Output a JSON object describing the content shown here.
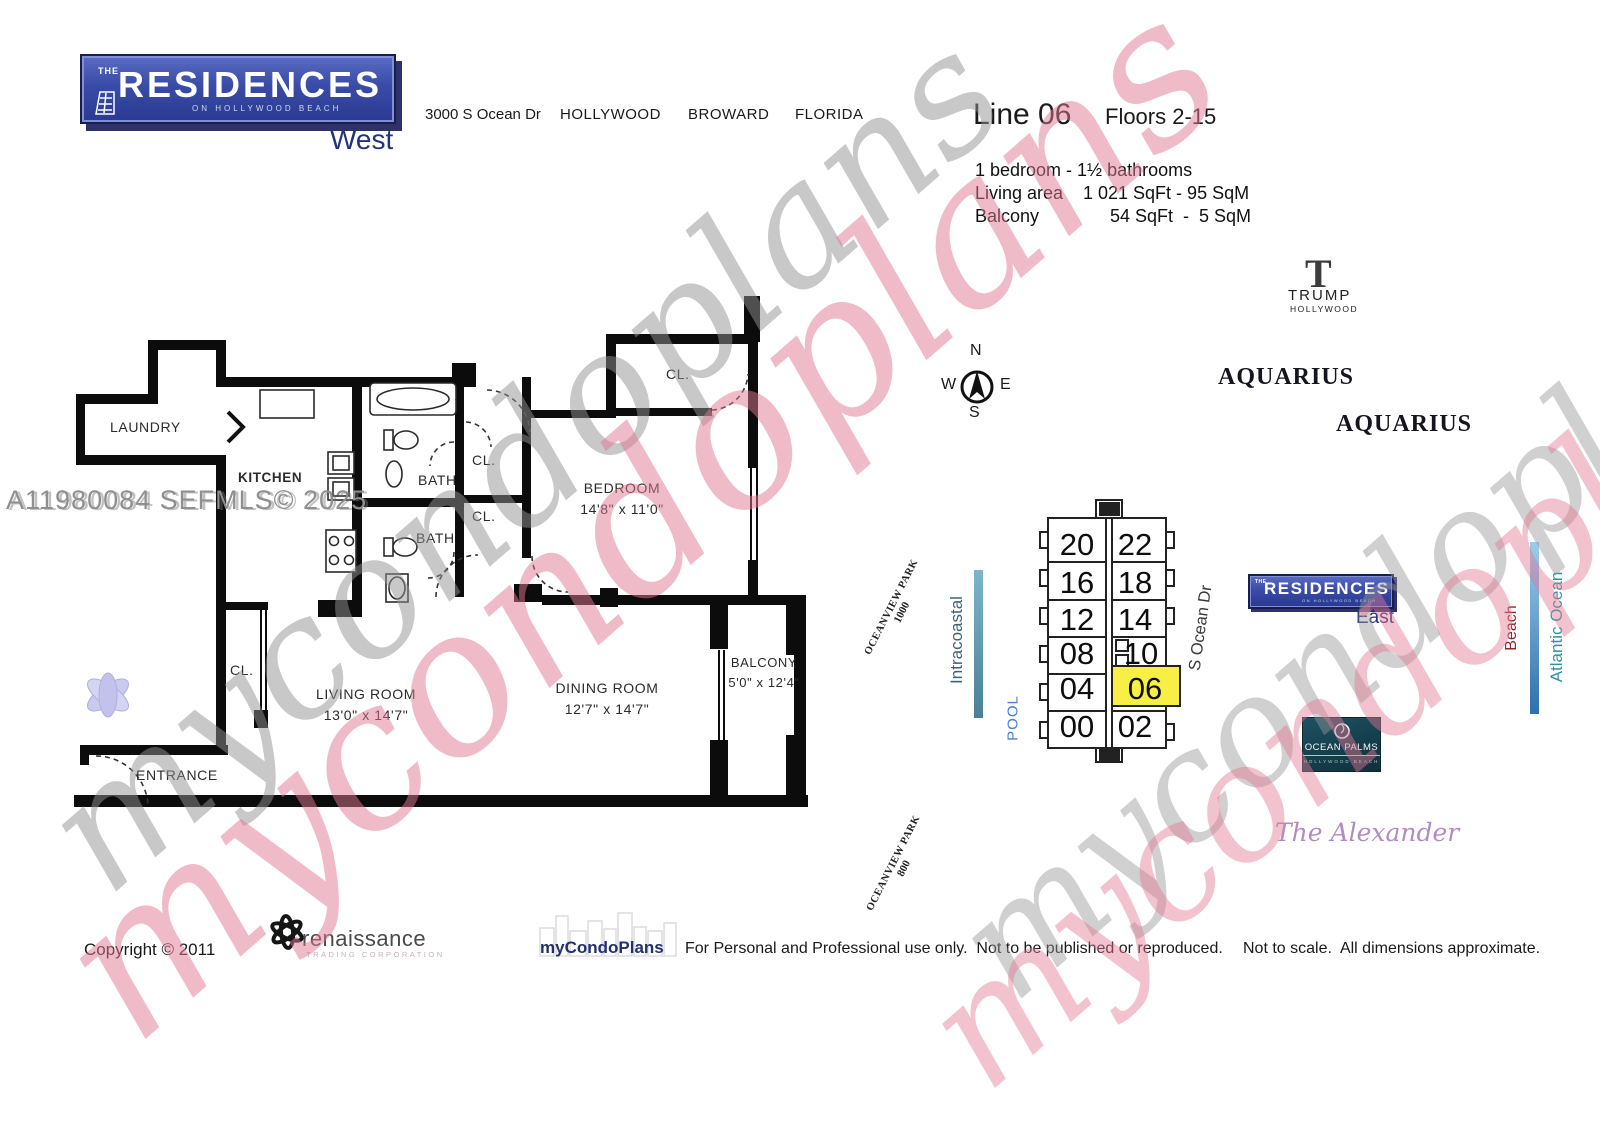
{
  "header": {
    "logo": {
      "the": "THE",
      "main": "RESIDENCES",
      "sub": "ON HOLLYWOOD BEACH",
      "wing": "West"
    },
    "address": "3000 S Ocean Dr",
    "city": "HOLLYWOOD",
    "county": "BROWARD",
    "state": "FLORIDA",
    "line_title": "Line 06",
    "floors": "Floors 2-15",
    "specs": {
      "beds": "1 bedroom - 1½ bathrooms",
      "living_label": "Living area",
      "living_value": "1 021 SqFt - 95 SqM",
      "balcony_label": "Balcony",
      "balcony_value": "54 SqFt  -  5 SqM"
    }
  },
  "floorplan": {
    "rooms": {
      "laundry": "LAUNDRY",
      "kitchen": "KITCHEN",
      "bath": "BATH",
      "closet": "CL.",
      "bedroom": {
        "name": "BEDROOM",
        "dims": "14'8\" x 11'0\""
      },
      "living": {
        "name": "LIVING ROOM",
        "dims": "13'0\" x 14'7\""
      },
      "dining": {
        "name": "DINING ROOM",
        "dims": "12'7\" x 14'7\""
      },
      "balcony": {
        "name": "BALCONY",
        "dims": "5'0\" x 12'4\""
      },
      "entrance": "ENTRANCE"
    }
  },
  "watermark": {
    "mls": "A11980084  SEFMLS© 2025",
    "script": "mycondoplans"
  },
  "map": {
    "compass": {
      "n": "N",
      "s": "S",
      "e": "E",
      "w": "W"
    },
    "trump": {
      "t": "T",
      "name": "TRUMP",
      "sub": "HOLLYWOOD"
    },
    "aquarius": "AQUARIUS",
    "units": [
      "20",
      "22",
      "16",
      "18",
      "12",
      "14",
      "08",
      "10",
      "04",
      "06",
      "00",
      "02"
    ],
    "highlighted_unit": "06",
    "pool": "POOL",
    "intracoastal": "Intracoastal",
    "park_north": {
      "name": "OCEANVIEW PARK",
      "number": "1000"
    },
    "park_south": {
      "name": "OCEANVIEW PARK",
      "number": "800"
    },
    "street": "S Ocean Dr",
    "east_logo": {
      "the": "THE",
      "main": "RESIDENCES",
      "sub": "ON HOLLYWOOD BEACH",
      "wing": "East"
    },
    "beach": "Beach",
    "ocean": "Atlantic Ocean",
    "ocean_palms": {
      "name": "OCEAN PALMS",
      "sub": "HOLLYWOOD BEACH"
    },
    "alexander": "The Alexander",
    "colors": {
      "highlight": "#f7ef45",
      "intracoastal_bar": "#5b93a8",
      "beach_bar": "#3f7fc0",
      "brand_blue": "#2e3f94"
    }
  },
  "footer": {
    "copyright": "Copyright © 2011",
    "renaissance": {
      "name": "renaissance",
      "sub": "TRADING CORPORATION"
    },
    "mycondoplans": "myCondoPlans",
    "usage": "For Personal and Professional use only.  Not to be published or reproduced.",
    "scale": "Not to scale.  All dimensions approximate."
  }
}
